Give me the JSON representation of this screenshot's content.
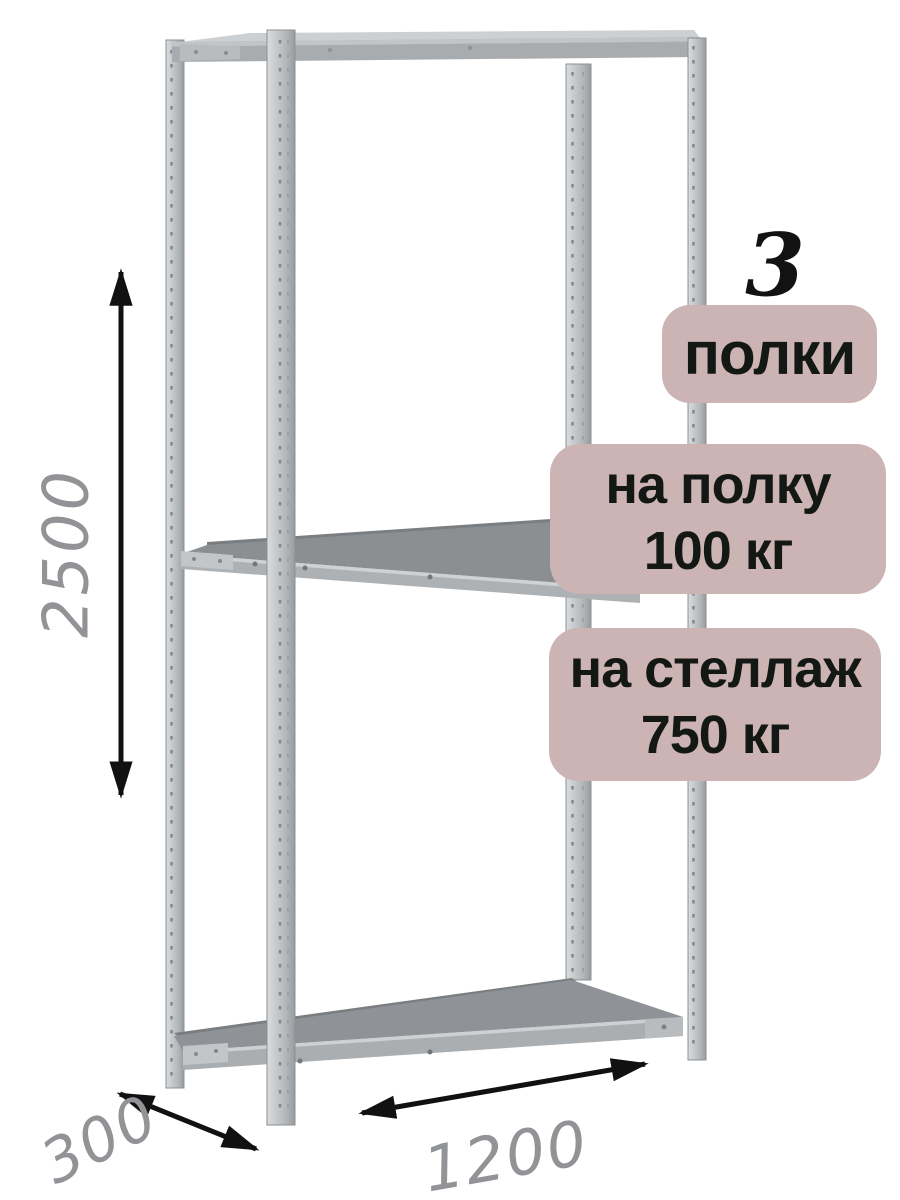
{
  "product": {
    "type": "metal-shelving-rack",
    "shelf_count_number": "3",
    "shelf_count_label": "полки",
    "per_shelf_load": {
      "line1": "на полку",
      "line2": "100 кг"
    },
    "per_rack_load": {
      "line1": "на стеллаж",
      "line2": "750 кг"
    },
    "dimensions": {
      "height_mm": "2500",
      "depth_mm": "300",
      "width_mm": "1200"
    }
  },
  "colors": {
    "background": "#ffffff",
    "badge_bg": "#cbb4b3",
    "badge_text": "#141814",
    "dimension_label_gray": "#919396",
    "arrow_black": "#111111",
    "metal_light": "#d9dbdd",
    "metal_mid": "#aeb1b4",
    "shelf_surface": "#8b8f92"
  }
}
